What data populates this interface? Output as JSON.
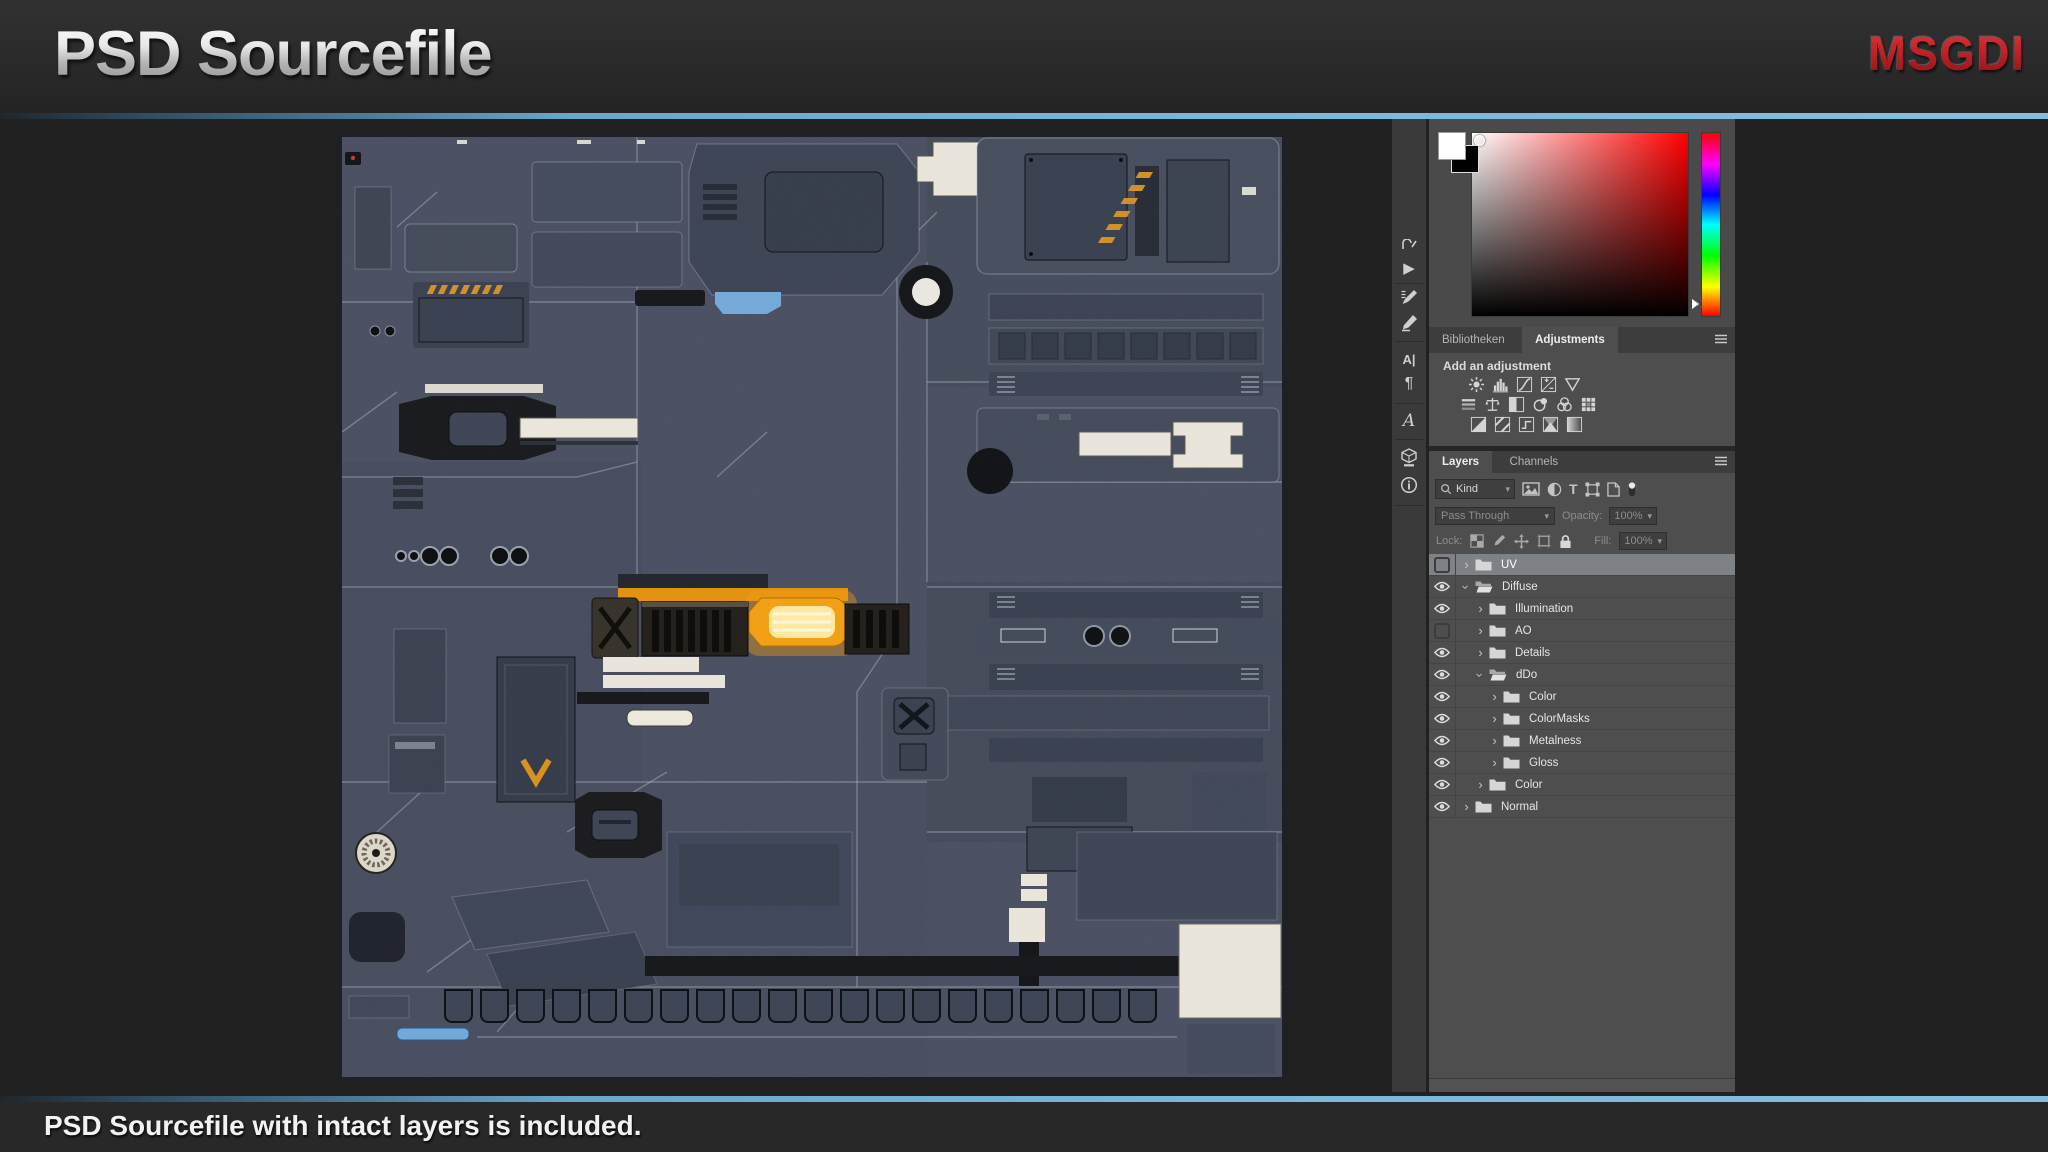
{
  "header": {
    "title": "PSD Sourcefile",
    "logo_text": "MSGDI"
  },
  "footer": {
    "caption": "PSD Sourcefile with intact layers is included."
  },
  "photoshop": {
    "toolbar_icons": [
      "clipped-tool",
      "play-actions",
      "brush-settings",
      "brushes",
      "character-panel",
      "paragraph-panel",
      "glyphs-panel",
      "3d-material",
      "info"
    ],
    "color_picker": {
      "foreground_swatch": "#ffffff",
      "background_swatch": "#000000",
      "hue": "red",
      "hue_slider_position": "93%"
    },
    "adjustments_panel": {
      "tabs": [
        {
          "label": "Bibliotheken",
          "active": false
        },
        {
          "label": "Adjustments",
          "active": true
        }
      ],
      "heading": "Add an adjustment",
      "icon_rows": [
        [
          "brightness-contrast",
          "levels",
          "curves",
          "exposure",
          "vibrance"
        ],
        [
          "hue-saturation",
          "color-balance",
          "black-white",
          "photo-filter",
          "channel-mixer",
          "color-lookup"
        ],
        [
          "invert",
          "posterize",
          "threshold",
          "gradient-map",
          "selective-color"
        ]
      ]
    },
    "layers_panel": {
      "tabs": [
        {
          "label": "Layers",
          "active": true
        },
        {
          "label": "Channels",
          "active": false
        }
      ],
      "filter": {
        "kind_label": "Kind",
        "icons": [
          "pixel-layer-filter",
          "adjustment-layer-filter",
          "type-layer-filter",
          "shape-layer-filter",
          "smart-object-filter",
          "filter-toggle"
        ]
      },
      "blend_mode": "Pass Through",
      "opacity_label": "Opacity:",
      "opacity_value": "100%",
      "lock_label": "Lock:",
      "lock_icons": [
        "lock-transparent-pixels",
        "lock-image-pixels",
        "lock-position",
        "lock-artboard",
        "lock-all"
      ],
      "fill_label": "Fill:",
      "fill_value": "100%",
      "layers": [
        {
          "name": "UV",
          "visible": false,
          "expanded": false,
          "indent": 0,
          "selected": true
        },
        {
          "name": "Diffuse",
          "visible": true,
          "expanded": true,
          "indent": 0,
          "selected": false
        },
        {
          "name": "Illumination",
          "visible": true,
          "expanded": false,
          "indent": 1,
          "selected": false
        },
        {
          "name": "AO",
          "visible": false,
          "expanded": false,
          "indent": 1,
          "selected": false
        },
        {
          "name": "Details",
          "visible": true,
          "expanded": false,
          "indent": 1,
          "selected": false
        },
        {
          "name": "dDo",
          "visible": true,
          "expanded": true,
          "indent": 1,
          "selected": false
        },
        {
          "name": "Color",
          "visible": true,
          "expanded": false,
          "indent": 2,
          "selected": false
        },
        {
          "name": "ColorMasks",
          "visible": true,
          "expanded": false,
          "indent": 2,
          "selected": false
        },
        {
          "name": "Metalness",
          "visible": true,
          "expanded": false,
          "indent": 2,
          "selected": false
        },
        {
          "name": "Gloss",
          "visible": true,
          "expanded": false,
          "indent": 2,
          "selected": false
        },
        {
          "name": "Color",
          "visible": true,
          "expanded": false,
          "indent": 1,
          "selected": false
        },
        {
          "name": "Normal",
          "visible": true,
          "expanded": false,
          "indent": 0,
          "selected": false
        }
      ]
    }
  },
  "colors": {
    "accent_line": "#7cb6da",
    "logo_red": "#c02227",
    "glow_orange": "#f2a013",
    "texture_base": "#4a5062"
  }
}
